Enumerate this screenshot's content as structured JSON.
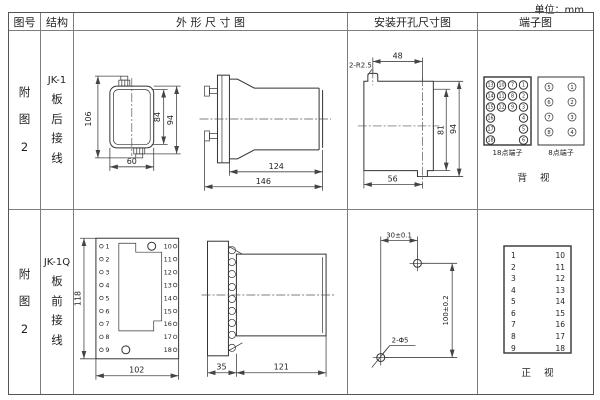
{
  "unit_label": "单位：mm",
  "headers": {
    "fig_no": "图号",
    "structure": "结构",
    "outline": "外 形 尺 寸 图",
    "install": "安装开孔尺寸图",
    "terminal": "端子图"
  },
  "row1": {
    "fig": [
      "附",
      "图",
      "2"
    ],
    "structure": {
      "model": "JK-1",
      "chars": [
        "板",
        "后",
        "接",
        "线"
      ]
    },
    "front": {
      "dim_left": "106",
      "dim_right_inner": "84",
      "dim_right_outer": "94",
      "dim_bottom": "60"
    },
    "side": {
      "dim_body": "124",
      "dim_total": "146"
    },
    "install": {
      "note": "2-R2.5",
      "dim_top": "48",
      "dim_right_inner": "81",
      "dim_right_outer": "94",
      "dim_bottom": "56"
    },
    "term18": {
      "label": "18点端子",
      "r1": [
        "13",
        "10",
        "7",
        "1"
      ],
      "r2": [
        "14",
        "11",
        "8",
        "2"
      ],
      "r3": [
        "15",
        "12",
        "9",
        "3"
      ],
      "r4": [
        "16",
        "4"
      ],
      "r5": [
        "17",
        "5"
      ],
      "r6": [
        "18",
        "6"
      ]
    },
    "term8": {
      "label": "8点端子",
      "left": [
        "5",
        "6",
        "7",
        "8"
      ],
      "right": [
        "1",
        "2",
        "3",
        "4"
      ]
    },
    "view_label": "背 视"
  },
  "row2": {
    "fig": [
      "附",
      "图",
      "2"
    ],
    "structure": {
      "model": "JK-1Q",
      "chars": [
        "板",
        "前",
        "接",
        "线"
      ]
    },
    "front": {
      "dim_left": "118",
      "dim_bottom": "102",
      "left_terms": [
        "1",
        "2",
        "3",
        "4",
        "5",
        "6",
        "7",
        "8",
        "9"
      ],
      "right_terms": [
        "10",
        "11",
        "12",
        "13",
        "14",
        "15",
        "16",
        "17",
        "18"
      ]
    },
    "side": {
      "dim_flange": "35",
      "dim_body": "121"
    },
    "install": {
      "dim_top": "30±0.1",
      "dim_right": "100±0.2",
      "note": "2-Φ5"
    },
    "terminal": {
      "left": [
        "1",
        "2",
        "3",
        "4",
        "5",
        "6",
        "7",
        "8",
        "9"
      ],
      "right": [
        "10",
        "11",
        "12",
        "13",
        "14",
        "15",
        "16",
        "17",
        "18"
      ],
      "view_label": "正 视"
    }
  }
}
